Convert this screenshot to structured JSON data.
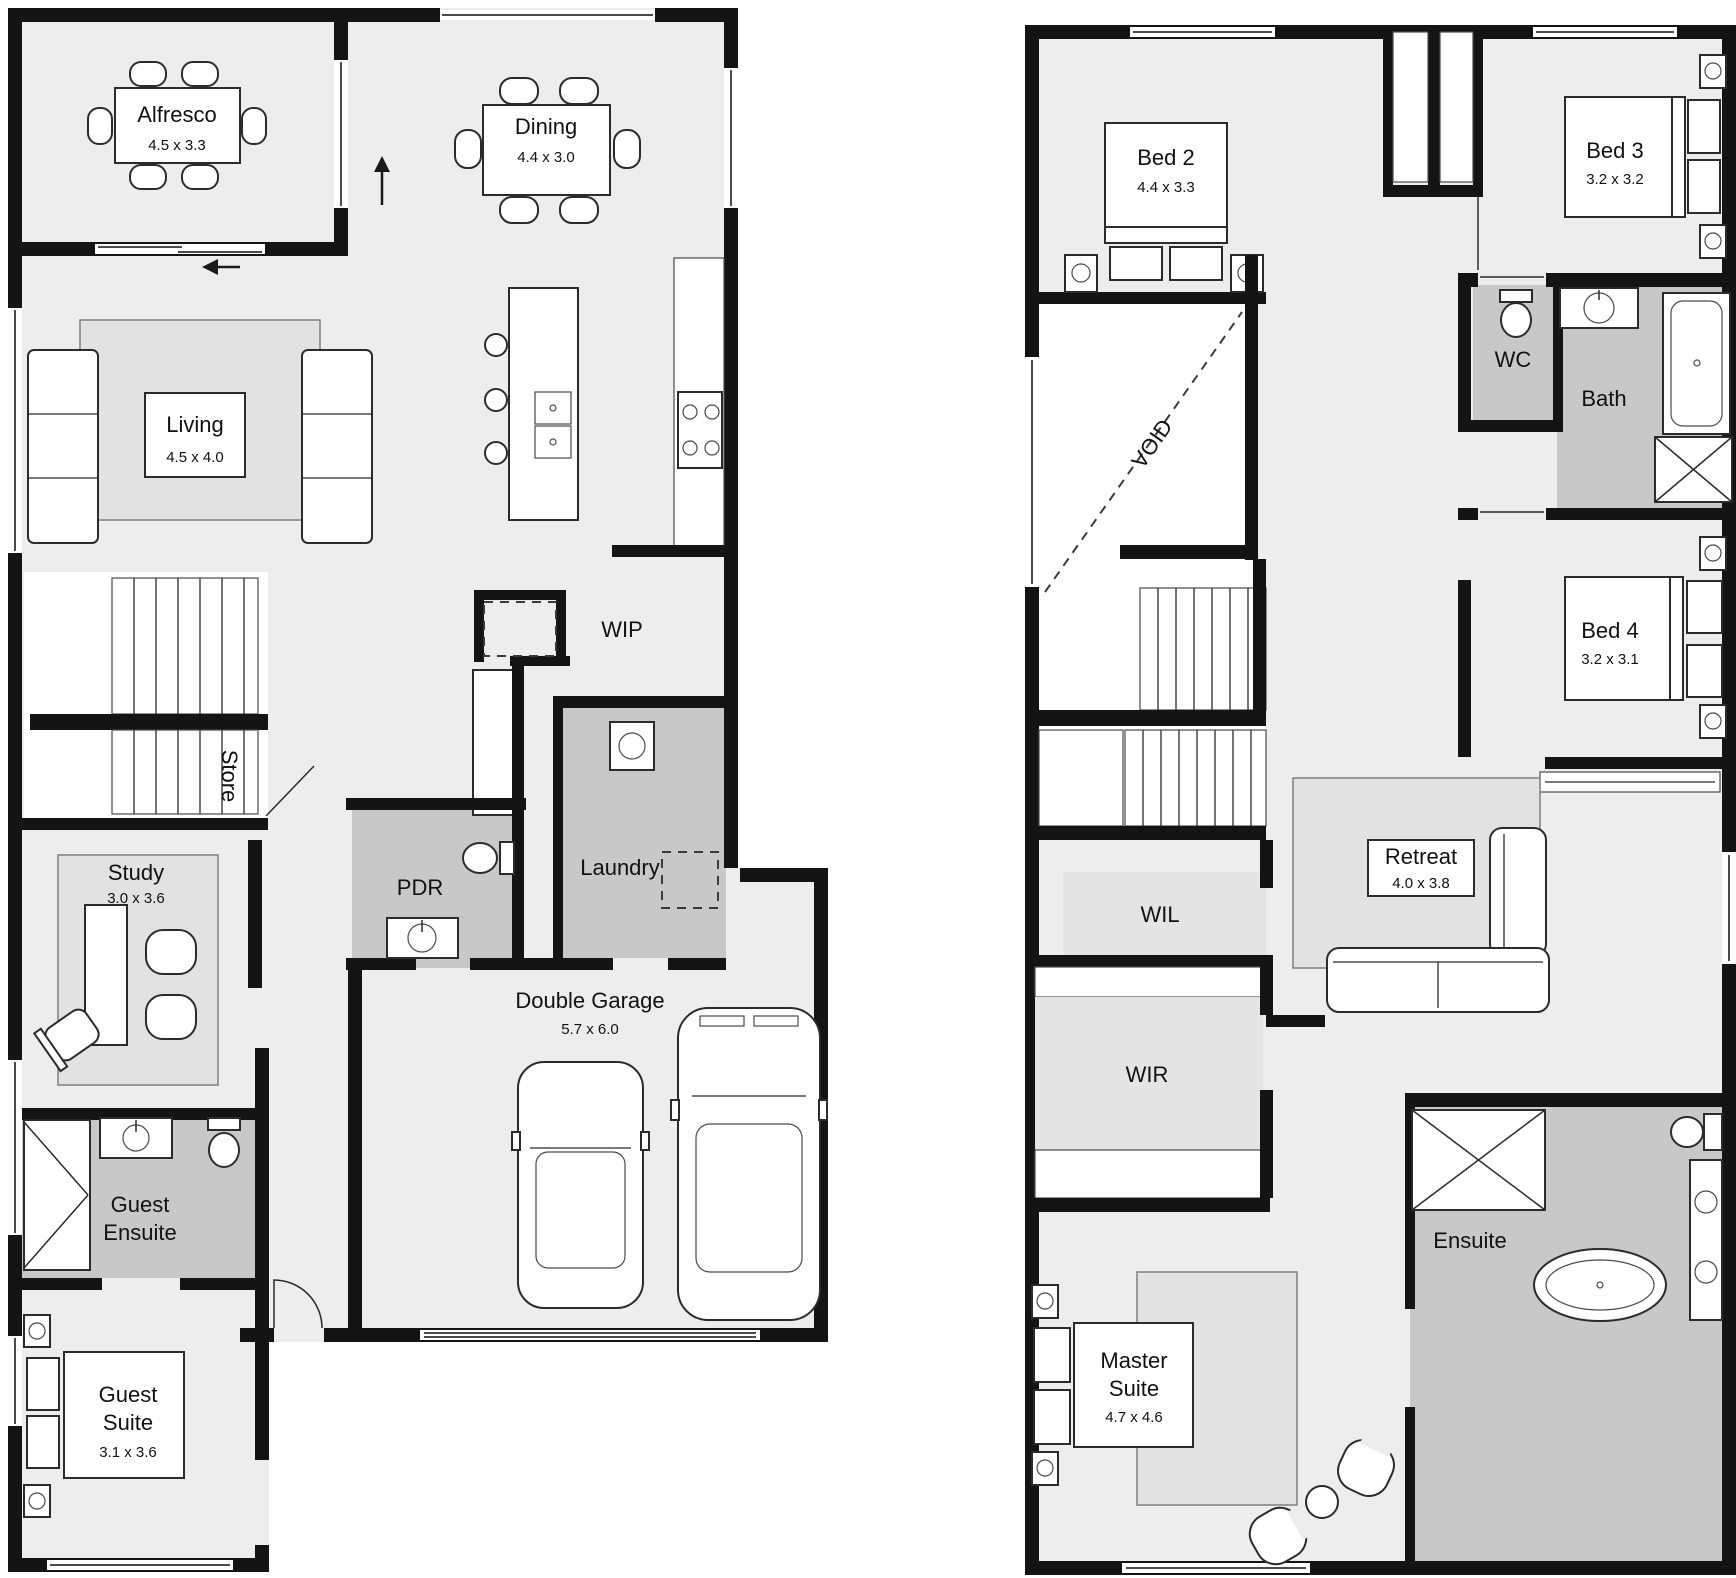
{
  "colors": {
    "wall": "#141414",
    "floor": "#ededed",
    "wet_area": "#c8c8c8"
  },
  "ground_floor": {
    "alfresco": {
      "name": "Alfresco",
      "dims": "4.5 x 3.3"
    },
    "dining": {
      "name": "Dining",
      "dims": "4.4 x 3.0"
    },
    "living": {
      "name": "Living",
      "dims": "4.5 x 4.0"
    },
    "wip": {
      "name": "WIP"
    },
    "store": {
      "name": "Store"
    },
    "study": {
      "name": "Study",
      "dims": "3.0 x 3.6"
    },
    "pdr": {
      "name": "PDR"
    },
    "laundry": {
      "name": "Laundry"
    },
    "guest_ensuite": {
      "line1": "Guest",
      "line2": "Ensuite"
    },
    "guest_suite": {
      "line1": "Guest",
      "line2": "Suite",
      "dims": "3.1 x 3.6"
    },
    "garage": {
      "name": "Double Garage",
      "dims": "5.7 x 6.0"
    }
  },
  "first_floor": {
    "bed2": {
      "name": "Bed 2",
      "dims": "4.4 x 3.3"
    },
    "bed3": {
      "name": "Bed 3",
      "dims": "3.2 x 3.2"
    },
    "wc": {
      "name": "WC"
    },
    "bath": {
      "name": "Bath"
    },
    "void": {
      "name": "VOID"
    },
    "bed4": {
      "name": "Bed 4",
      "dims": "3.2 x 3.1"
    },
    "wil": {
      "name": "WIL"
    },
    "wir": {
      "name": "WIR"
    },
    "retreat": {
      "name": "Retreat",
      "dims": "4.0 x 3.8"
    },
    "master_suite": {
      "line1": "Master",
      "line2": "Suite",
      "dims": "4.7 x 4.6"
    },
    "ensuite": {
      "name": "Ensuite"
    }
  }
}
